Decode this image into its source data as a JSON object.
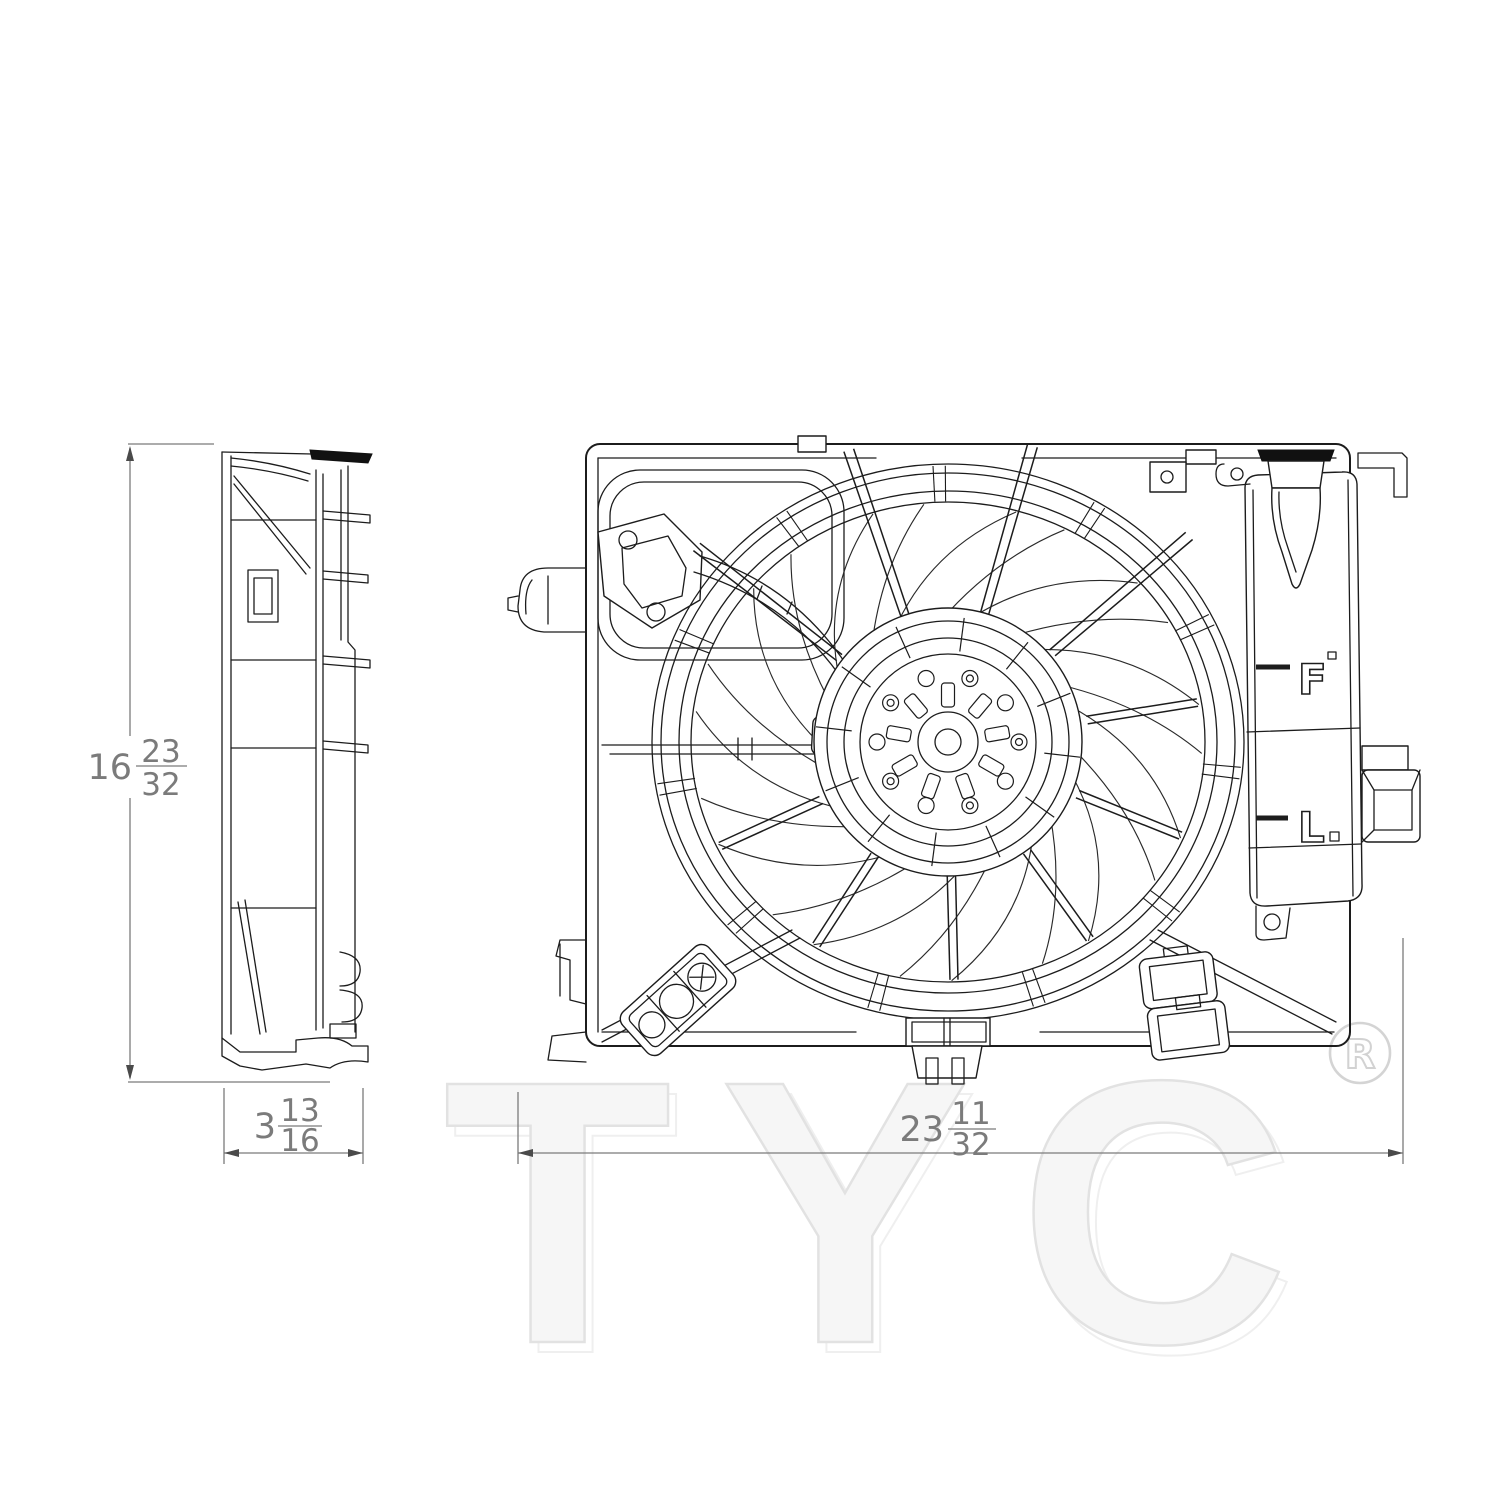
{
  "watermark": {
    "brand": "TYC",
    "registered_symbol": "R"
  },
  "reservoir_markings": {
    "full_label": "F",
    "low_label": "L"
  },
  "dimensions": {
    "height": {
      "whole": "16",
      "num": "23",
      "den": "32"
    },
    "depth": {
      "whole": "3",
      "num": "13",
      "den": "16"
    },
    "width": {
      "whole": "23",
      "num": "11",
      "den": "32"
    }
  }
}
